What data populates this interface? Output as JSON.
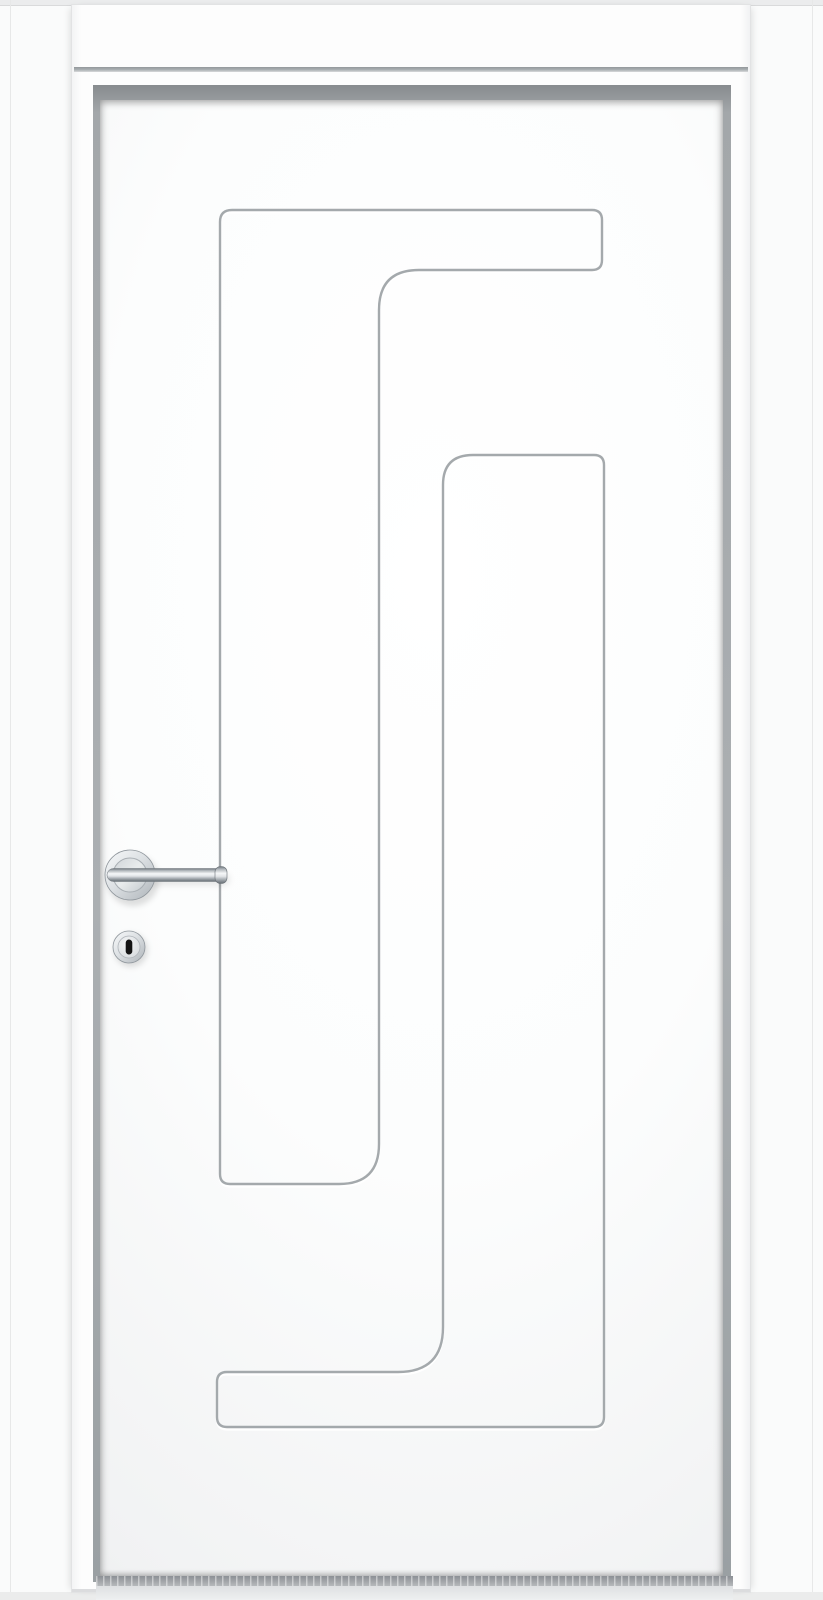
{
  "image": {
    "type": "product-photo",
    "subject": "White interior door, closed, front elevation view",
    "style": "modern flush door with routed greek-key / S-shaped groove pattern, flat white casing and rebated jamb"
  },
  "door": {
    "slab": {
      "finish": "matte white",
      "pattern": "two routed groove bands forming an interlocking S / meander motif",
      "groove_bands": [
        {
          "name": "upper-band",
          "shape": "inverted-L (gamma) outline: top bar with long left leg"
        },
        {
          "name": "lower-band",
          "shape": "J outline: long right leg with foot bar at bottom"
        }
      ]
    },
    "hardware": {
      "handle": {
        "type": "straight lever on round rose",
        "finish": "polished chrome / stainless steel",
        "position": "left side of slab",
        "orientation": "lever pointing right"
      },
      "keyhole": {
        "type": "round key escutcheon below handle",
        "finish": "polished chrome / stainless steel",
        "slot": "vertical dark key slot"
      }
    },
    "frame": {
      "casing": "flat white architrave, both sides and head",
      "jamb": "white with dark rebate shadow around slab"
    }
  },
  "palette": {
    "wall": "#fafbfb",
    "wall_top_strip": "#ebeced",
    "casing_face": "#fdfdfd",
    "head_casing_shadow": "#94989b",
    "rebate_shadow": "#9aa0a3",
    "door_face_center": "#ffffff",
    "door_face_edge": "#e9eaeb",
    "groove_line": "#9aa0a3",
    "groove_highlight": "#ffffff",
    "chrome_light": "#f5f7f8",
    "chrome_mid": "#c6ccd1",
    "chrome_dark": "#6e757b",
    "keyhole_slot": "#141414",
    "floor_shadow": "#8c9095",
    "floor_light": "#eef0f1"
  }
}
